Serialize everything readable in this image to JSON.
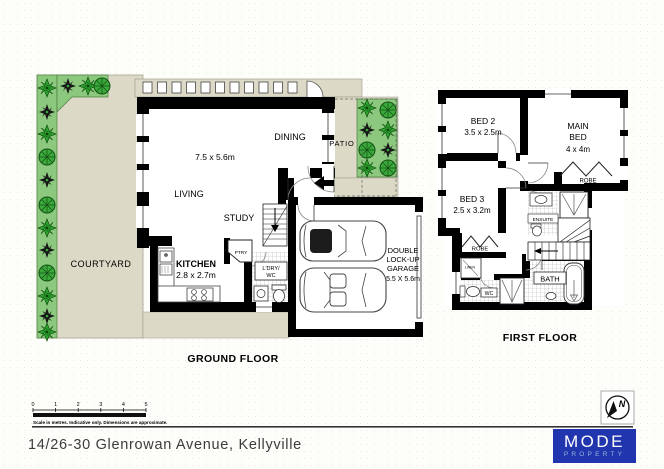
{
  "ground_floor": {
    "label": "GROUND FLOOR",
    "rooms": {
      "courtyard": "COURTYARD",
      "living": "LIVING",
      "dining": "DINING",
      "study": "STUDY",
      "living_dims": "7.5 x 5.6m",
      "kitchen": "KITCHEN",
      "kitchen_dims": "2.8 x 2.7m",
      "pantry": "PTRY",
      "laundry_line1": "L'DRY/",
      "laundry_line2": "WC",
      "patio": "PATIO",
      "garage_line1": "DOUBLE",
      "garage_line2": "LOCK-UP",
      "garage_line3": "GARAGE",
      "garage_dims": "5.5 X 5.6m"
    }
  },
  "first_floor": {
    "label": "FIRST FLOOR",
    "rooms": {
      "bed2": "BED 2",
      "bed2_dims": "3.5 x 2.5m",
      "main_bed_line1": "MAIN",
      "main_bed_line2": "BED",
      "main_bed_dims": "4 x 4m",
      "bed3": "BED 3",
      "bed3_dims": "2.5 x 3.2m",
      "robe_main": "ROBE",
      "robe_bed3": "ROBE",
      "ensuite": "ENSUITE",
      "linen": "LINEN",
      "wc": "WC",
      "bath": "BATH"
    }
  },
  "scale_bar": {
    "ticks": [
      "0",
      "1",
      "2",
      "3",
      "4",
      "5"
    ],
    "caption": "Scale in metres. Indicative only. Dimensions are approximate."
  },
  "footer": {
    "address": "14/26-30 Glenrowan Avenue, Kellyville"
  },
  "compass": {
    "letter": "N"
  },
  "logo": {
    "name": "MODE",
    "tagline": "PROPERTY",
    "bg_color": "#2136ae",
    "tagline_color": "#8fb6db"
  },
  "colors": {
    "paving": "#dcdac6",
    "garden": "#8cc87e",
    "plant_green": "#2ea22e",
    "wall": "#000000"
  }
}
